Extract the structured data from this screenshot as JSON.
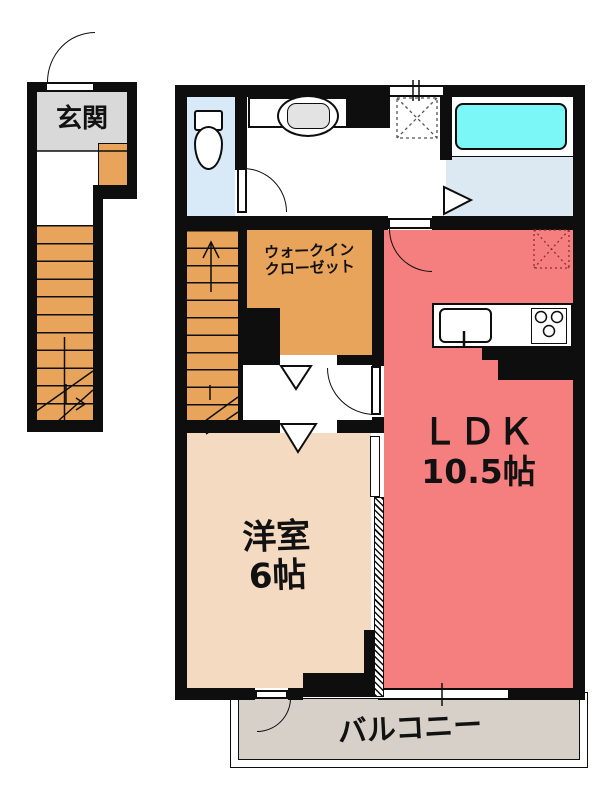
{
  "plan": {
    "type": "apartment-floor-plan",
    "rooms": {
      "genkan": {
        "label": "玄関"
      },
      "wic": {
        "label_line1": "ウォークイン",
        "label_line2": "クローゼット"
      },
      "youshitsu": {
        "label_line1": "洋室",
        "label_line2": "6帖"
      },
      "ldk": {
        "label_line1": "ＬＤＫ",
        "label_line2": "10.5帖"
      },
      "balcony": {
        "label": "バルコニー"
      }
    },
    "fixtures": [
      "toilet",
      "vanity-sink",
      "bathtub",
      "washer-space",
      "kitchen-sink",
      "stove",
      "stairs",
      "interior-stairs"
    ],
    "colors": {
      "wall": "#0e0e0e",
      "stairs_orange": "#e9a45c",
      "wic_orange": "#e9a45c",
      "youshitsu_beige": "#f4dac1",
      "ldk_pink": "#f57e7e",
      "toilet_blue": "#d8e9f7",
      "bath_floor_blue": "#dce8f2",
      "bathtub_cyan": "#7bf7f7",
      "genkan_gray": "#d9d9d9",
      "balcony_gray": "#d7d0c9"
    }
  }
}
